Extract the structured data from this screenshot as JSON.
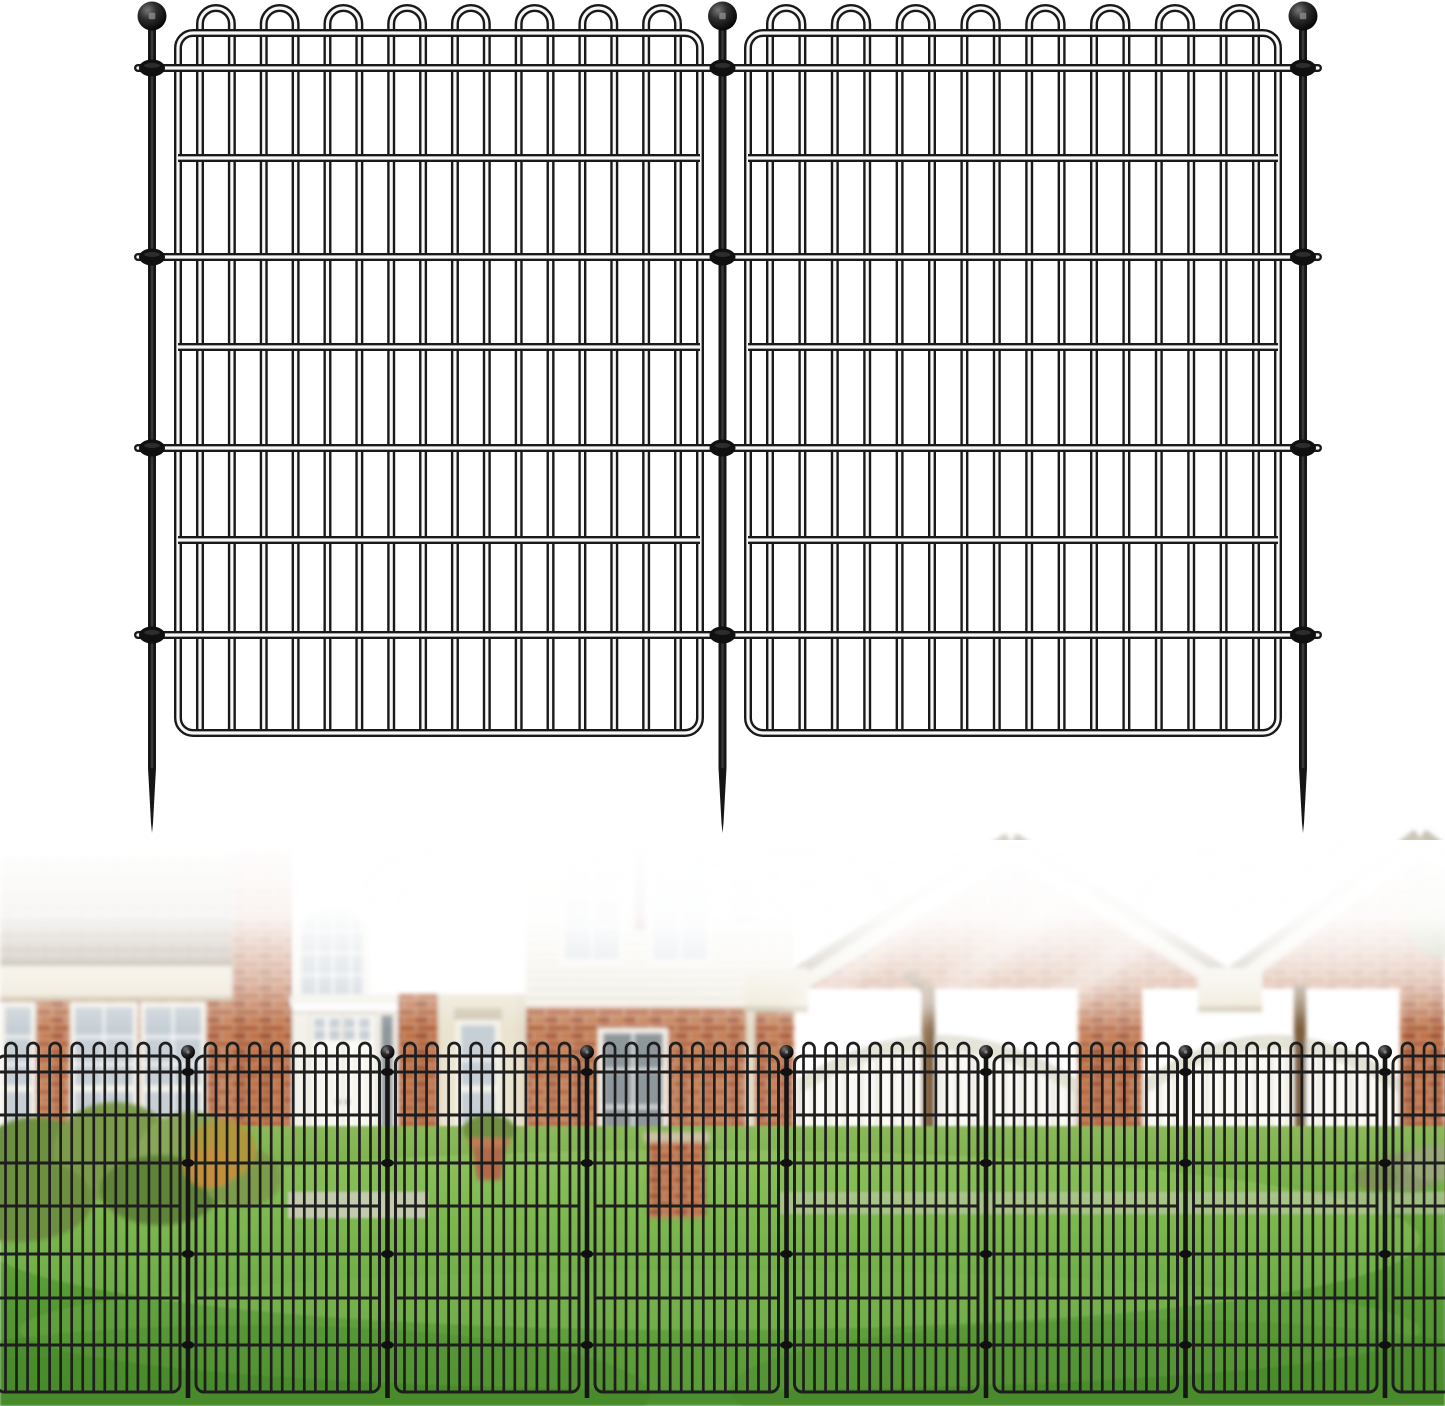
{
  "canvas": {
    "width": 1445,
    "height": 1406,
    "background": "#ffffff"
  },
  "illustration_fence": {
    "stroke_dark": "#191919",
    "stroke_core": "#f7f7f7",
    "outer_w": 8,
    "core_w": 3.2,
    "posts": [
      152,
      722.5,
      1303
    ],
    "ball": {
      "cy": 16,
      "r": 14.5
    },
    "post": {
      "w": 8,
      "top": 29,
      "spike_start": 768,
      "tip": 833
    },
    "collar_rails": {
      "ys": [
        68,
        257,
        448,
        635
      ],
      "x1": 138,
      "x2": 1318
    },
    "collar": {
      "rx": 13,
      "ry": 8.5
    },
    "panels": [
      {
        "x1": 178,
        "x2": 700
      },
      {
        "x1": 748,
        "x2": 1278
      }
    ],
    "frame": {
      "top": 33,
      "bottom": 733,
      "radius": 15
    },
    "inner_rails": [
      158,
      347,
      540
    ],
    "loop_top": 8,
    "wire_inset": 22,
    "wires_per_panel": 16
  },
  "photo": {
    "fence": {
      "stroke": "#1e1e1e",
      "wire_w": 2.7,
      "rail_w": 3,
      "posts": [
        188,
        387.5,
        587,
        786.5,
        986,
        1185.5,
        1385
      ],
      "ball": {
        "cy": 1052,
        "r": 7
      },
      "post": {
        "w": 4.6,
        "top": 1058,
        "bottom": 1398
      },
      "collar_rails": {
        "ys": [
          1072,
          1163,
          1254,
          1345
        ],
        "x1": 0,
        "x2": 1445
      },
      "collar": {
        "rx": 6,
        "ry": 4
      },
      "panels": [
        {
          "x1": -3.5,
          "x2": 180
        },
        {
          "x1": 196,
          "x2": 379.5
        },
        {
          "x1": 395.5,
          "x2": 579
        },
        {
          "x1": 595,
          "x2": 778.5
        },
        {
          "x1": 794.5,
          "x2": 978
        },
        {
          "x1": 994,
          "x2": 1177.5
        },
        {
          "x1": 1193.5,
          "x2": 1377
        },
        {
          "x1": 1393,
          "x2": 1576.5
        }
      ],
      "frame": {
        "top": 1056,
        "bottom": 1392,
        "radius": 8
      },
      "inner_rails": [
        1115,
        1206,
        1298
      ],
      "loop_top": 1043,
      "wire_inset": 9,
      "wires_per_panel": 16
    },
    "lawn": {
      "y_top": 1126,
      "stops": [
        [
          "0",
          "#8cb95a"
        ],
        [
          "0.28",
          "#6fae41"
        ],
        [
          "0.6",
          "#569a33"
        ],
        [
          "1",
          "#4b8f2d"
        ]
      ],
      "sweep": "#aeda79",
      "shadow": "#3c7a24",
      "light": "#8cc55e"
    },
    "house": {
      "brick": "#b5653f",
      "brick_dark": "#a9583a",
      "brick_light": "#c27a50",
      "mortar": "#dcb794",
      "brickB": "#b15f38",
      "brickB_dark": "#a04e2e",
      "brickB_light": "#c06a40",
      "mortarB": "#d8ae8a",
      "roof": "#a2937a",
      "roof_dark": "#80715a",
      "roof_light": "#b3a68c",
      "trim_cream": "#eae3cf",
      "trim_shadow": "#c9bfa5",
      "wall_white": "#f3f2ea",
      "door_white": "#fbfaf5",
      "panel_line": "#dcd9ca",
      "frame_white": "#f6f4ec",
      "glass": "#c6cfd6",
      "glass_dark": "#8e979b",
      "muntin": "#ffffff",
      "siding": "#f2efe4",
      "siding_line": "#ddd8c5",
      "shingle_gable": "#8d7d60",
      "downspout": "#7d5f3e",
      "downspout_hi": "#a07a50",
      "accent_red": "#7e3a33",
      "concrete": "#cfccbe",
      "bush1": "#7d9c4c",
      "bush2": "#8aa758",
      "bush3": "#6d8f41",
      "bush4": "#9aa94f",
      "bush5": "#b0973b",
      "bush_dark": "#5e8438",
      "pot": "#b06a4a",
      "pot_rim": "#c07a55",
      "plant": "#6f8f3f",
      "cap_stone": "#cdbfa4",
      "shrub_gray": "#8a9a6a",
      "shrub_gray2": "#9aa878",
      "tree": "#7e9a5e"
    }
  }
}
